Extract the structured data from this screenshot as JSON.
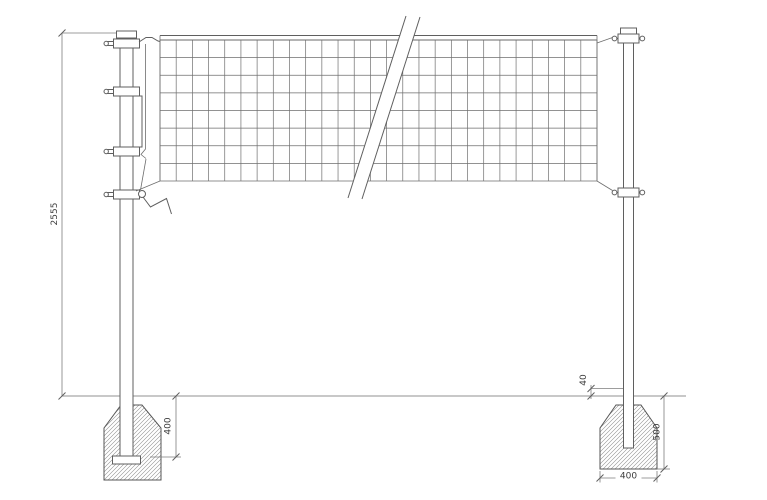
{
  "drawing": {
    "type": "technical-dimension-drawing",
    "subject": "volleyball-net-posts-with-concrete-foundations",
    "colors": {
      "background": "#ffffff",
      "object_line": "#5f5f5f",
      "dimension_line": "#7d7d7d",
      "hatch": "#8d8d8d",
      "text": "#3c3c3c"
    },
    "dimensions": {
      "overall_post_height": "2555",
      "left_foundation_embed_depth": "400",
      "post_ground_offset": "40",
      "right_foundation_depth": "500",
      "right_foundation_width": "400"
    }
  }
}
